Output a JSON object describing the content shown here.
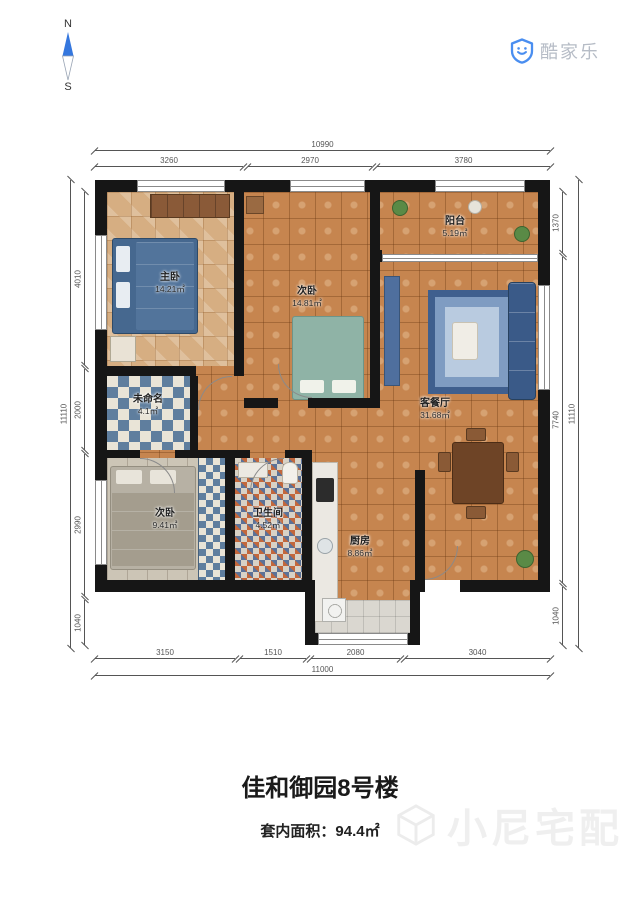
{
  "compass": {
    "north": "N",
    "south": "S"
  },
  "logo": {
    "brand": "酷家乐"
  },
  "icons": {
    "logo": "smile-shield",
    "compass": "needle",
    "watermark": "cube"
  },
  "colors": {
    "brand_blue": "#4a8ef0",
    "compass_blue": "#3577de",
    "wall": "#161616",
    "floor_terracotta": "#c6854f"
  },
  "plan": {
    "rooms": [
      {
        "name": "主卧",
        "area": "14.21㎡"
      },
      {
        "name": "次卧",
        "area": "14.81㎡"
      },
      {
        "name": "阳台",
        "area": "5.19㎡"
      },
      {
        "name": "客餐厅",
        "area": "31.68㎡"
      },
      {
        "name": "未命名",
        "area": "4.1㎡"
      },
      {
        "name": "次卧",
        "area": "9.41㎡"
      },
      {
        "name": "卫生间",
        "area": "4.52㎡"
      },
      {
        "name": "厨房",
        "area": "8.86㎡"
      }
    ]
  },
  "dimensions": {
    "top": {
      "overall": "10990",
      "segments": [
        "3260",
        "2970",
        "3780"
      ]
    },
    "bottom": {
      "overall": "11000",
      "segments": [
        "3150",
        "1510",
        "2080",
        "3040"
      ]
    },
    "left": {
      "overall": "11110",
      "segments": [
        "4010",
        "2000",
        "2990",
        "1040"
      ]
    },
    "right": {
      "overall": "11110",
      "segments": [
        "1370",
        "7740",
        "1040"
      ]
    }
  },
  "footer": {
    "title": "佳和御园8号楼",
    "area_label": "套内面积：",
    "area_value": "94.4㎡",
    "watermark": "小尼宅配"
  }
}
